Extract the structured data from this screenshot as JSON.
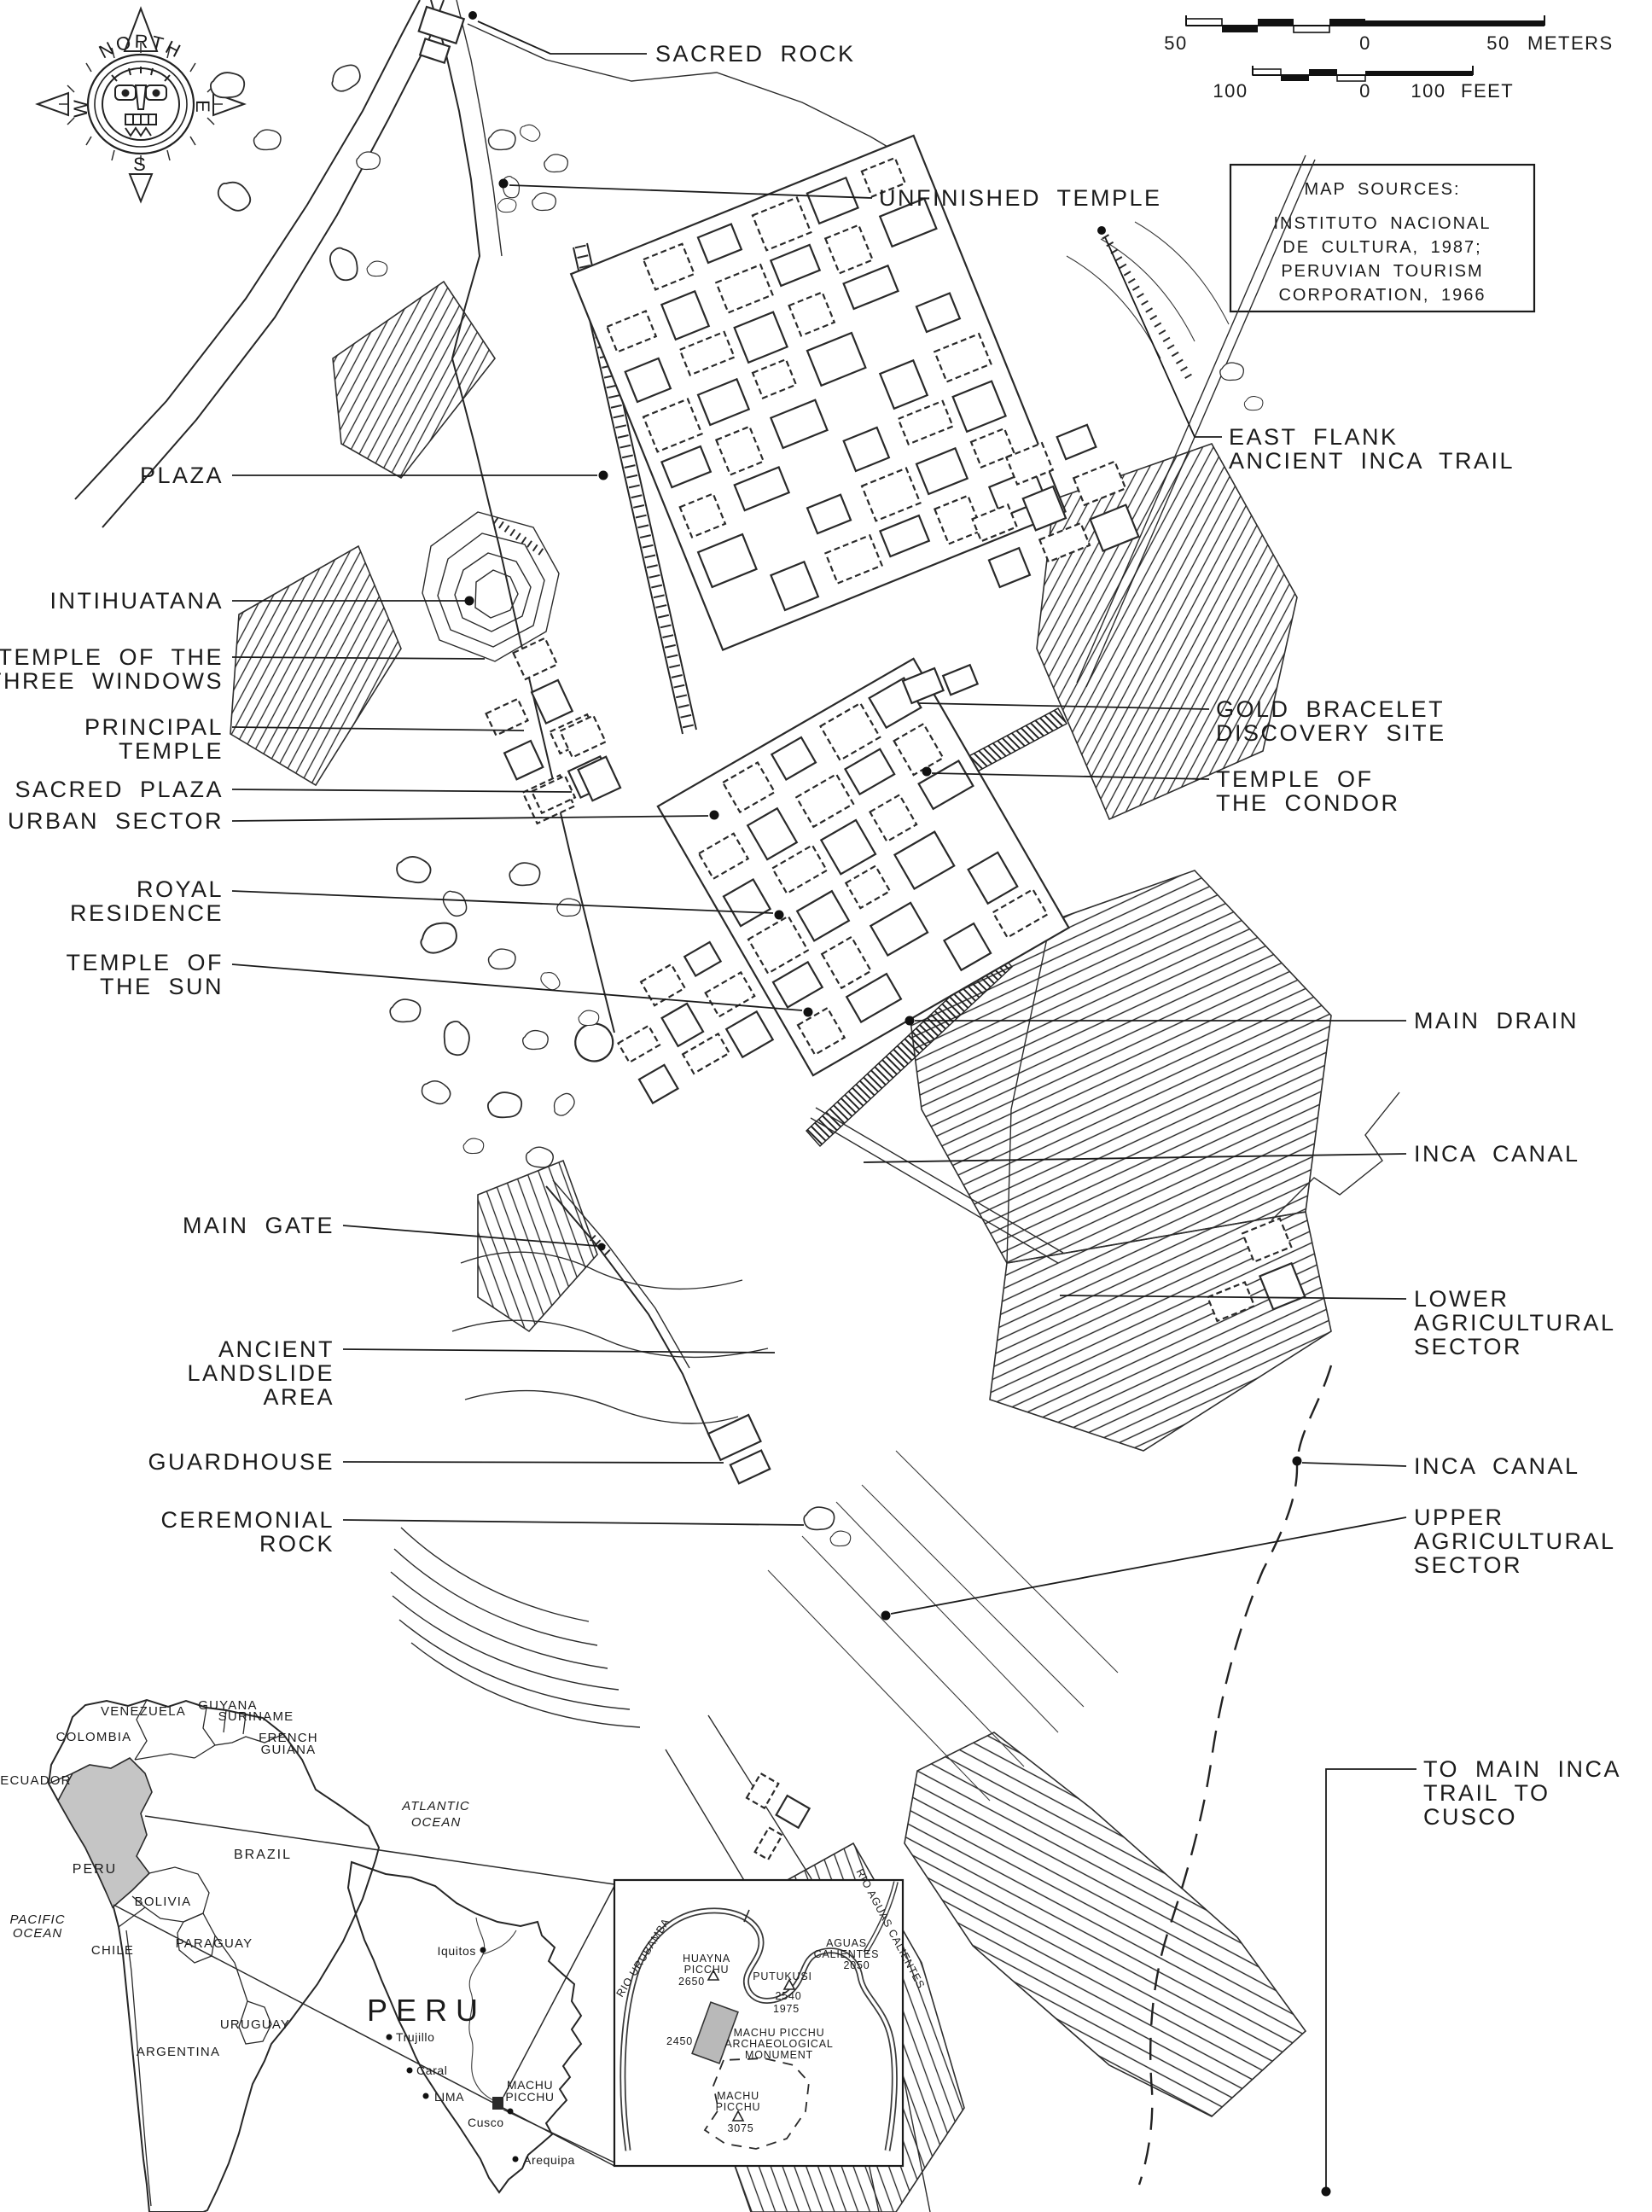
{
  "compass": {
    "north": "NORTH",
    "west": "W",
    "east": "E",
    "south": "S"
  },
  "scalebar": {
    "m_left": "50",
    "m_zero": "0",
    "m_right": "50",
    "m_unit": "METERS",
    "f_left": "100",
    "f_zero": "0",
    "f_right": "100",
    "f_unit": "FEET"
  },
  "sources": {
    "title": "MAP SOURCES:",
    "line1": "INSTITUTO NACIONAL",
    "line2": "DE CULTURA, 1987;",
    "line3": "PERUVIAN TOURISM",
    "line4": "CORPORATION, 1966"
  },
  "callouts": {
    "plaza": "PLAZA",
    "intihuatana": "INTIHUATANA",
    "three_windows_1": "TEMPLE OF THE",
    "three_windows_2": "THREE WINDOWS",
    "principal_1": "PRINCIPAL",
    "principal_2": "TEMPLE",
    "sacred_plaza": "SACRED PLAZA",
    "urban_sector": "URBAN SECTOR",
    "royal_1": "ROYAL",
    "royal_2": "RESIDENCE",
    "sun_1": "TEMPLE OF",
    "sun_2": "THE SUN",
    "main_gate": "MAIN GATE",
    "landslide_1": "ANCIENT",
    "landslide_2": "LANDSLIDE",
    "landslide_3": "AREA",
    "guardhouse": "GUARDHOUSE",
    "ceremonial_1": "CEREMONIAL",
    "ceremonial_2": "ROCK",
    "sacred_rock": "SACRED ROCK",
    "unfinished_temple": "UNFINISHED TEMPLE",
    "east_flank_1": "EAST FLANK",
    "east_flank_2": "ANCIENT INCA TRAIL",
    "gold_1": "GOLD BRACELET",
    "gold_2": "DISCOVERY SITE",
    "condor_1": "TEMPLE OF",
    "condor_2": "THE CONDOR",
    "main_drain": "MAIN DRAIN",
    "inca_canal_upper": "INCA CANAL",
    "lower_1": "LOWER",
    "lower_2": "AGRICULTURAL",
    "lower_3": "SECTOR",
    "inca_canal_lower": "INCA CANAL",
    "upper_1": "UPPER",
    "upper_2": "AGRICULTURAL",
    "upper_3": "SECTOR",
    "cusco_trail_1": "TO MAIN INCA",
    "cusco_trail_2": "TRAIL TO",
    "cusco_trail_3": "CUSCO"
  },
  "sa": {
    "venezuela": "VENEZUELA",
    "guyana": "GUYANA",
    "suriname": "SURINAME",
    "french_1": "FRENCH",
    "french_2": "GUIANA",
    "colombia": "COLOMBIA",
    "ecuador": "ECUADOR",
    "peru": "PERU",
    "brazil": "BRAZIL",
    "bolivia": "BOLIVIA",
    "paraguay": "PARAGUAY",
    "chile": "CHILE",
    "uruguay": "URUGUAY",
    "argentina": "ARGENTINA",
    "pacific_1": "PACIFIC",
    "pacific_2": "OCEAN",
    "atlantic_1": "ATLANTIC",
    "atlantic_2": "OCEAN"
  },
  "peru_map": {
    "country": "PERU",
    "iquitos": "Iquitos",
    "trujillo": "Trujillo",
    "caral": "Caral",
    "lima": "LIMA",
    "cusco": "Cusco",
    "arequipa": "Arequipa",
    "mp_1": "MACHU",
    "mp_2": "PICCHU"
  },
  "detail": {
    "rio_urubamba": "RIO URUBAMBA",
    "rio_aguas": "RIO AGUAS CALIENTES",
    "huayna_1": "HUAYNA",
    "huayna_2": "PICCHU",
    "huayna_elev": "2650",
    "putukusi": "PUTUKUSI",
    "putukusi_elev": "2540",
    "river_elev": "1975",
    "aguas_1": "AGUAS",
    "aguas_2": "CALIENTES",
    "aguas_elev": "2050",
    "mon_1": "MACHU PICCHU",
    "mon_2": "ARCHAEOLOGICAL",
    "mon_3": "MONUMENT",
    "mon_elev": "2450",
    "peak_1": "MACHU",
    "peak_2": "PICCHU",
    "peak_elev": "3075"
  },
  "colors": {
    "ink": "#1b1b1b",
    "peru_fill": "#c5c5c5",
    "monument_fill": "#b9b9b9"
  }
}
